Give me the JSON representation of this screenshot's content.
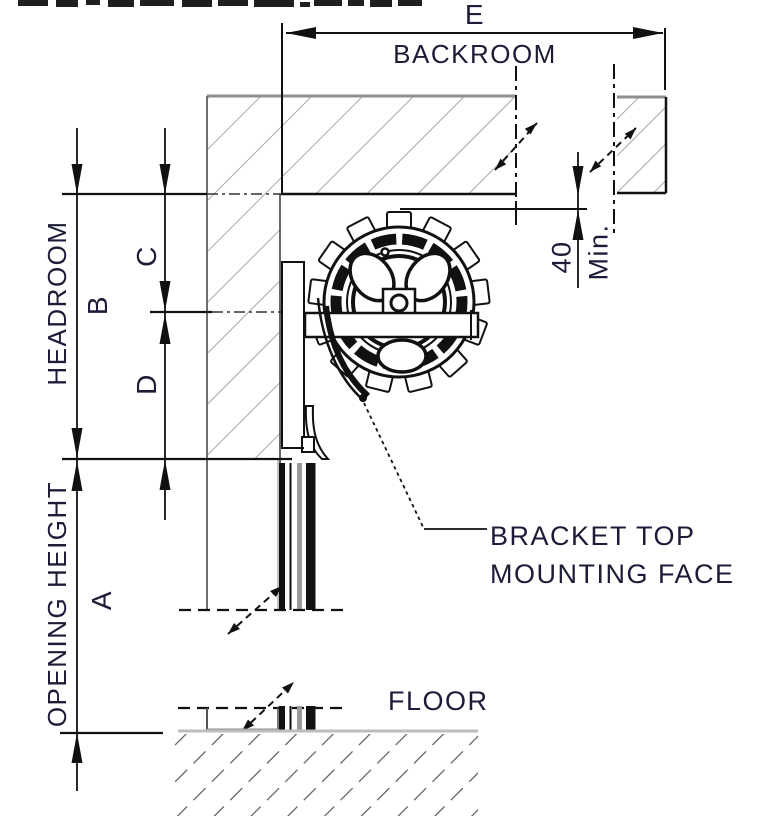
{
  "drawing": {
    "dim_labels": {
      "e": "E",
      "backroom": "BACKROOM",
      "b": "B",
      "headroom": "HEADROOM",
      "c": "C",
      "d": "D",
      "a": "A",
      "opening_height": "OPENING HEIGHT",
      "clearance_value": "40",
      "clearance_qualifier": "Min."
    },
    "annotations": {
      "bracket_top": "BRACKET TOP",
      "mounting_face": "MOUNTING FACE",
      "floor": "FLOOR"
    },
    "colors": {
      "line": "#111111",
      "text": "#1c1c38",
      "hatch": "#a8a8a8",
      "edge_gray": "#8f8f8f",
      "floor_line": "#bdbdbd",
      "ground_hatch": "#555555"
    }
  }
}
